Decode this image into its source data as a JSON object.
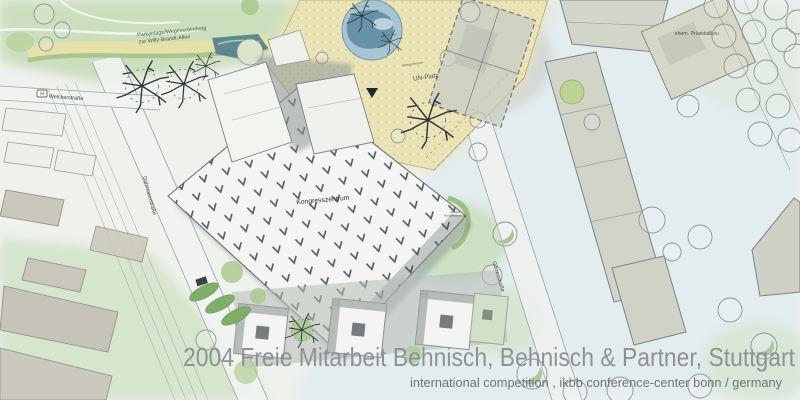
{
  "caption": {
    "title": "2004 Freie Mitarbeit Behnisch, Behnisch & Partner, Stuttgart",
    "subtitle": "international competition , ikbb conference-center bonn / germany"
  },
  "plan_labels": {
    "park_connection_line1": "Parkanlage/Wegeverbindung",
    "park_connection_line2": "zur Willy-Brandt-Allee",
    "street_welckerstrasse": "Welckerstraße",
    "street_dahlmannstrasse": "Dahlmannstraße",
    "street_goerresstrasse": "Görresstraße",
    "congress_center": "Kongresszentrum",
    "un_platz": "UN-Platz",
    "water_basin": "Wasserbecken",
    "drop_off_line1": "Vorfahrt",
    "drop_off_line2": "Kongresszentrum",
    "former_presidential_building": "ehem. Präsidialbau",
    "bus_stop_sign": "H"
  },
  "colors": {
    "paper": "#eff1ed",
    "plaza_yellow": "#ebe4b7",
    "water_blue": "#a6c6d4",
    "park_green": "#c9ddbb",
    "building_gray": "#d2d4c9",
    "caption_gray": "#8a8e90"
  }
}
